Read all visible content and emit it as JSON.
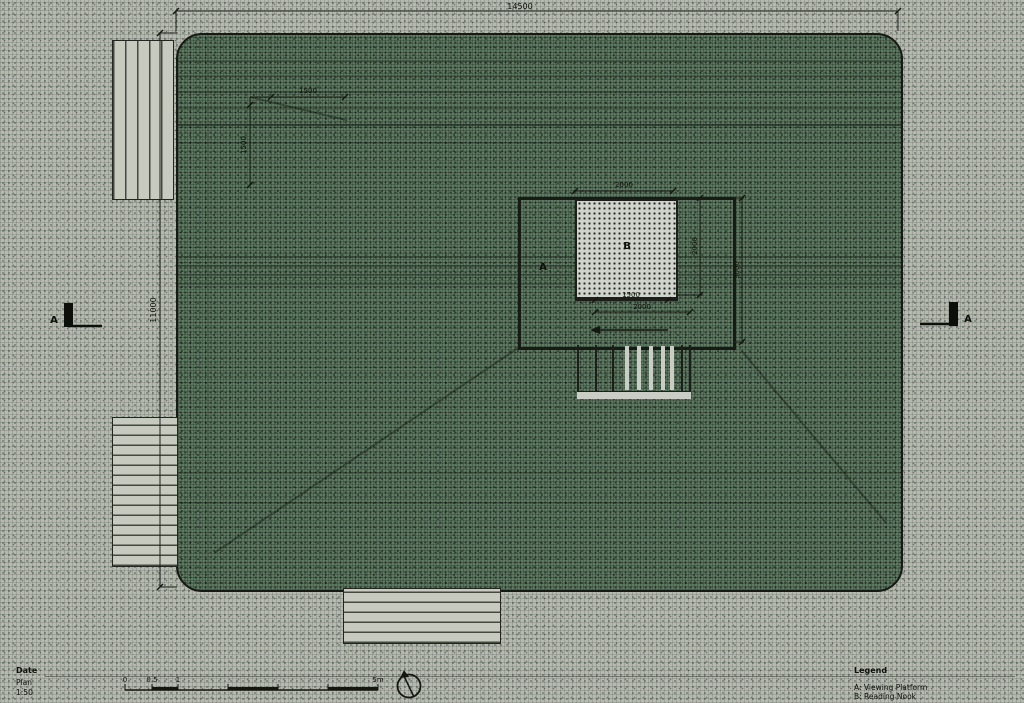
{
  "drawing": {
    "title_block": {
      "date_label": "Date",
      "plan_label": "Plan",
      "scale_value": "1:50"
    },
    "legend": {
      "title": "Legend",
      "item_a": "A: Viewing Platform",
      "item_b": "B: Reading Nook"
    },
    "scale_bar": {
      "tick_0": "0",
      "tick_05": "0.5",
      "tick_1": "1",
      "tick_5": "5m"
    },
    "dimensions": {
      "overall_width": "14500",
      "overall_height": "11000",
      "offset_horizontal": "1500",
      "offset_vertical": "1500",
      "building_width": "2000",
      "building_height": "2000",
      "platform_height": "3000",
      "step_inner": "1500",
      "step_outer": "2000"
    },
    "labels": {
      "building": "B",
      "platform": "A",
      "section_left": "A",
      "section_right": "A"
    },
    "colors": {
      "line": "#1c1f19",
      "field_green": "#5e7a62",
      "paper": "#b5bab0",
      "light_fill": "#cfd3cb"
    }
  }
}
